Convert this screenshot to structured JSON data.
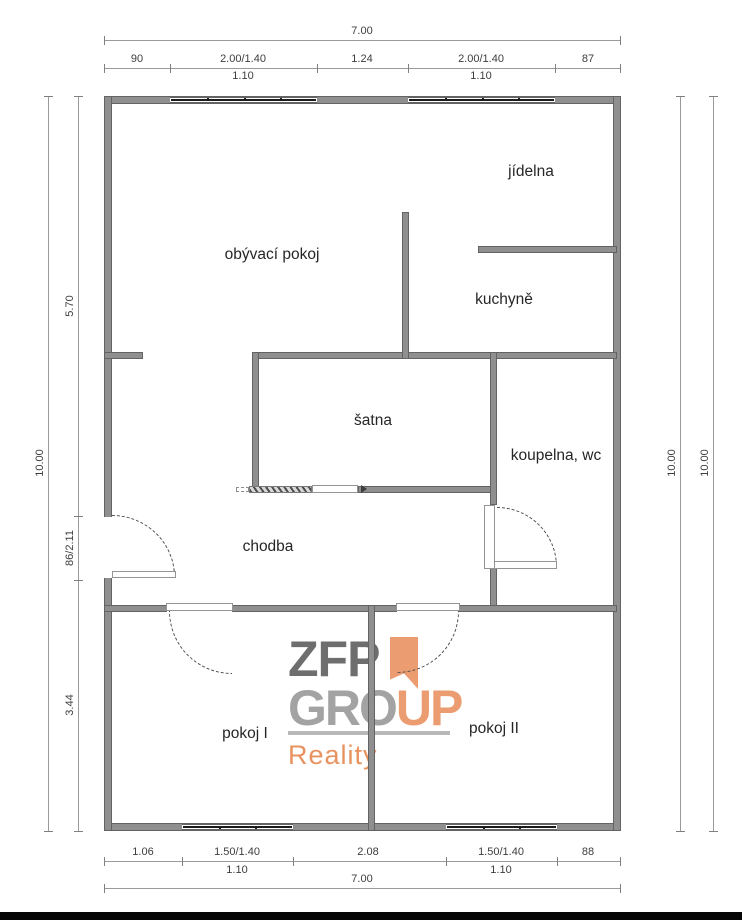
{
  "rooms": {
    "living": "obývací pokoj",
    "dining": "jídelna",
    "kitchen": "kuchyně",
    "closet": "šatna",
    "bathroom": "koupelna, wc",
    "hallway": "chodba",
    "room1": "pokoj I",
    "room2": "pokoj II"
  },
  "dims": {
    "top": {
      "total": "7.00",
      "segments": [
        "90",
        "2.00/1.40",
        "1.24",
        "2.00/1.40",
        "87"
      ],
      "subs": [
        "1.10",
        "1.10"
      ]
    },
    "bottom": {
      "total": "7.00",
      "segments": [
        "1.06",
        "1.50/1.40",
        "2.08",
        "1.50/1.40",
        "88"
      ],
      "subs": [
        "1.10",
        "1.10"
      ]
    },
    "left": {
      "total": "10.00",
      "segments": [
        "5.70",
        "86/2.11",
        "3.44"
      ]
    },
    "right": {
      "totals": [
        "10.00",
        "10.00"
      ]
    }
  },
  "logo": {
    "zfp": "ZFP",
    "group_gray": "GRO",
    "group_orange": "UP",
    "reality": "Reality"
  },
  "colors": {
    "wall": "#8f8f8f",
    "window_line": "#1b1b1b",
    "dimension_line": "#9a9a9a",
    "logo_dark_gray": "#6e6e6e",
    "logo_light_gray": "#a3a3a3",
    "logo_orange": "#eb9c70",
    "reality_orange": "#e8935f"
  }
}
